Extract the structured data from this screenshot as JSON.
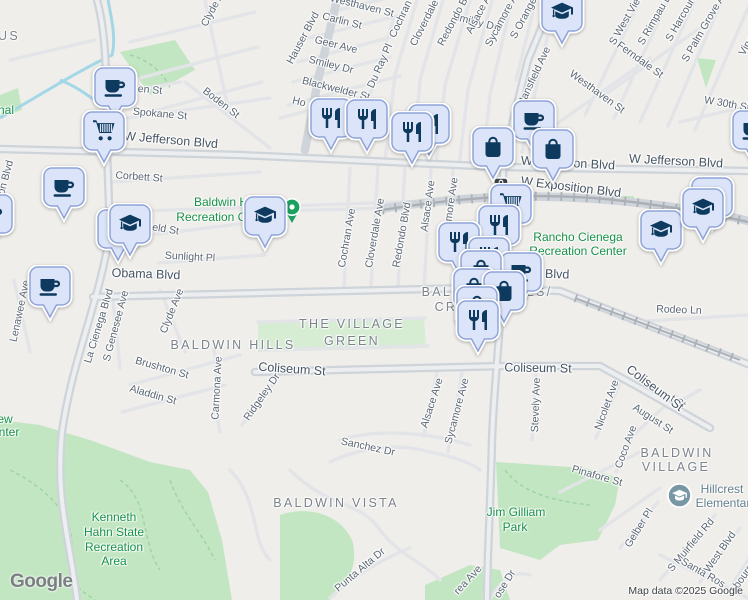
{
  "attribution": {
    "logo": "Google",
    "map_data": "Map data ©2025 Google"
  },
  "palette": {
    "land": "#f0eeea",
    "park_fill": "#c3e6c2",
    "park_label": "#179149",
    "pin_fill": "#dbe4f8",
    "pin_border": "#8fa3d7",
    "pin_icon": "#0d3a5e",
    "street_label": "#5a6673",
    "district_label": "#7b838b",
    "green_dot": "#1aa05f",
    "school_poi": "#7897a5",
    "water": "#a3d7e8"
  },
  "map": {
    "labels": [
      [
        "Smiley Dr",
        475,
        22,
        14,
        "st"
      ],
      [
        "Clyde Ave",
        215,
        5,
        -62,
        "st"
      ],
      [
        "Westhaven St",
        362,
        6,
        14,
        "st"
      ],
      [
        "Carlin St",
        342,
        21,
        14,
        "st"
      ],
      [
        "Geer Ave",
        336,
        45,
        14,
        "st"
      ],
      [
        "Smiley Dr",
        331,
        65,
        14,
        "st"
      ],
      [
        "Blackwelder St",
        336,
        89,
        14,
        "st"
      ],
      [
        "Ho",
        299,
        102,
        14,
        "st"
      ],
      [
        "Hauser Blvd",
        303,
        38,
        -62,
        "st"
      ],
      [
        "Du Ray Pl",
        380,
        66,
        -66,
        "st"
      ],
      [
        "Cochran Ave",
        405,
        10,
        -65,
        "st"
      ],
      [
        "Cloverdale Ave",
        429,
        14,
        -63,
        "st"
      ],
      [
        "Redondo Blvd",
        456,
        16,
        -62,
        "st"
      ],
      [
        "Alsace Ave",
        481,
        10,
        -62,
        "st"
      ],
      [
        "Sycamore Ave",
        504,
        16,
        -62,
        "st"
      ],
      [
        "S Orange Dr",
        527,
        12,
        -62,
        "st"
      ],
      [
        "Mansfield Ave",
        534,
        77,
        -65,
        "st"
      ],
      [
        "S West View St",
        630,
        13,
        -60,
        "st"
      ],
      [
        "S Rimpau Blvd",
        658,
        14,
        -60,
        "st"
      ],
      [
        "S Harcourt Ave",
        686,
        10,
        -60,
        "st"
      ],
      [
        "S Palm Grove Ave",
        706,
        24,
        -60,
        "st"
      ],
      [
        "Vineyard Ave",
        757,
        28,
        -60,
        "st"
      ],
      [
        "Ferndale St",
        640,
        60,
        36,
        "st"
      ],
      [
        "Westhaven St",
        597,
        92,
        36,
        "st"
      ],
      [
        "W 30th St",
        727,
        104,
        10,
        "st"
      ],
      [
        "Boden St",
        221,
        103,
        38,
        "st"
      ],
      [
        "Spokane St",
        160,
        114,
        5,
        "st"
      ],
      [
        "en St",
        150,
        90,
        5,
        "st"
      ],
      [
        "Corbett St",
        139,
        177,
        4,
        "st"
      ],
      [
        "field St",
        163,
        229,
        9,
        "st"
      ],
      [
        "Sunlight Pl",
        190,
        257,
        3,
        "st"
      ],
      [
        "son Blvd",
        5,
        180,
        -75,
        "st"
      ],
      [
        "Cochran Ave",
        347,
        238,
        -80,
        "st"
      ],
      [
        "Cloverdale Ave",
        375,
        233,
        -80,
        "st"
      ],
      [
        "Redondo Blvd",
        402,
        235,
        -80,
        "st"
      ],
      [
        "Alsace Ave",
        428,
        206,
        -82,
        "st"
      ],
      [
        "Sycamore Ave",
        450,
        211,
        -82,
        "st"
      ],
      [
        "La Cienega Blvd",
        99,
        326,
        -73,
        "st"
      ],
      [
        "S Genesee Ave",
        116,
        326,
        -75,
        "st"
      ],
      [
        "Lenawee Ave",
        20,
        311,
        -78,
        "st"
      ],
      [
        "Clyde Ave",
        172,
        311,
        -68,
        "st"
      ],
      [
        "Brushton St",
        162,
        368,
        16,
        "st"
      ],
      [
        "Aladdin St",
        153,
        395,
        16,
        "st"
      ],
      [
        "Carmona Ave",
        217,
        388,
        -87,
        "st"
      ],
      [
        "Ridgeley Dr",
        262,
        397,
        -55,
        "st"
      ],
      [
        "Rodeo Ln",
        679,
        310,
        2,
        "st"
      ],
      [
        "Alsace Ave",
        432,
        403,
        -72,
        "st"
      ],
      [
        "Sycamore Ave",
        457,
        411,
        -75,
        "st"
      ],
      [
        "Stevely Ave",
        536,
        405,
        -88,
        "st"
      ],
      [
        "Nicolet Ave",
        607,
        405,
        -70,
        "st"
      ],
      [
        "August St",
        653,
        419,
        33,
        "st"
      ],
      [
        "t St",
        678,
        402,
        33,
        "st"
      ],
      [
        "Coco Ave",
        626,
        447,
        -70,
        "st"
      ],
      [
        "Pinafore St",
        597,
        476,
        16,
        "st"
      ],
      [
        "Sanchez Dr",
        368,
        447,
        12,
        "st"
      ],
      [
        "Punta Alta Dr",
        360,
        570,
        -40,
        "st"
      ],
      [
        "ose Dr",
        505,
        584,
        -58,
        "st"
      ],
      [
        "rea Ave",
        468,
        580,
        -47,
        "st"
      ],
      [
        "Gelber Pl",
        639,
        528,
        -58,
        "st"
      ],
      [
        "S Muirfield Rd",
        691,
        545,
        -50,
        "st"
      ],
      [
        "West Blvd",
        720,
        552,
        -55,
        "st"
      ],
      [
        "Santa Ros",
        703,
        573,
        30,
        "st"
      ],
      [
        "Abourne Rd",
        748,
        570,
        -55,
        "st"
      ],
      [
        "W Jefferson Blvd",
        171,
        140,
        5,
        "stb"
      ],
      [
        "W Jefferson Blvd",
        568,
        163,
        3,
        "stb"
      ],
      [
        "W Jefferson Blvd",
        676,
        161,
        3,
        "stb"
      ],
      [
        "W Exposition Blvd",
        571,
        187,
        7,
        "stb"
      ],
      [
        "Obama Blvd",
        146,
        274,
        2,
        "stb"
      ],
      [
        "a Blvd",
        552,
        274,
        2,
        "stb"
      ],
      [
        "Coliseum St",
        292,
        369,
        4,
        "stb"
      ],
      [
        "Coliseum St",
        538,
        368,
        1,
        "stb"
      ],
      [
        "Coliseum St",
        655,
        388,
        37,
        "stb"
      ],
      [
        "US",
        9,
        36,
        0,
        "d"
      ],
      [
        "BALDWIN HILLS",
        233,
        345,
        0,
        "d"
      ],
      [
        "THE VILLAGE",
        352,
        324,
        0,
        "d"
      ],
      [
        "GREEN",
        352,
        341,
        0,
        "d"
      ],
      [
        "BALDWIN HILLS/",
        487,
        292,
        0,
        "d"
      ],
      [
        "CRENSHAW",
        480,
        307,
        0,
        "d"
      ],
      [
        "BALDWIN VISTA",
        336,
        503,
        0,
        "d"
      ],
      [
        "BALDWIN",
        677,
        453,
        0,
        "d"
      ],
      [
        "VILLAGE",
        676,
        467,
        0,
        "d"
      ],
      [
        "nal",
        6,
        110,
        0,
        "p"
      ],
      [
        "Baldwin Hills",
        228,
        202,
        0,
        "p"
      ],
      [
        "Recreation Center",
        225,
        217,
        0,
        "p"
      ],
      [
        "Rancho Cienega",
        578,
        237,
        0,
        "p"
      ],
      [
        "Recreation Center",
        578,
        251,
        0,
        "p"
      ],
      [
        "ew",
        5,
        419,
        0,
        "p"
      ],
      [
        "nter",
        9,
        432,
        0,
        "p"
      ],
      [
        "Kenneth",
        114,
        517,
        0,
        "p"
      ],
      [
        "Hahn State",
        114,
        532,
        0,
        "p"
      ],
      [
        "Recreation",
        114,
        547,
        0,
        "p"
      ],
      [
        "Area",
        114,
        561,
        0,
        "p"
      ],
      [
        "Jim Gilliam",
        516,
        512,
        0,
        "p"
      ],
      [
        "Park",
        515,
        527,
        0,
        "p"
      ],
      [
        "Hillcrest",
        722,
        489,
        0,
        "poi"
      ],
      [
        "Elementary",
        726,
        503,
        0,
        "poi"
      ]
    ],
    "pins": [
      [
        "coffee",
        115,
        88
      ],
      [
        "shopping-cart",
        104,
        132
      ],
      [
        "coffee",
        64,
        188
      ],
      [
        "coffee",
        -8,
        215
      ],
      [
        "graduation-cap",
        118,
        230
      ],
      [
        "graduation-cap",
        130,
        225
      ],
      [
        "coffee",
        50,
        287
      ],
      [
        "green-dot",
        292,
        207
      ],
      [
        "graduation-cap",
        265,
        217
      ],
      [
        "restaurant",
        331,
        119
      ],
      [
        "restaurant",
        367,
        120
      ],
      [
        "restaurant",
        429,
        125
      ],
      [
        "restaurant",
        412,
        133
      ],
      [
        "coffee",
        534,
        121
      ],
      [
        "shopping-bag",
        493,
        148
      ],
      [
        "shopping-bag",
        553,
        150
      ],
      [
        "graduation-cap",
        562,
        13
      ],
      [
        "coffee",
        753,
        131
      ],
      [
        "metro-station",
        501,
        185
      ],
      [
        "shopping-cart",
        511,
        205
      ],
      [
        "restaurant",
        499,
        226
      ],
      [
        "restaurant",
        459,
        243
      ],
      [
        "restaurant",
        489,
        258
      ],
      [
        "coffee",
        521,
        273
      ],
      [
        "shopping-bag",
        481,
        271
      ],
      [
        "shopping-bag",
        474,
        289
      ],
      [
        "shopping-bag",
        504,
        292
      ],
      [
        "shopping-bag",
        477,
        307
      ],
      [
        "restaurant",
        478,
        321
      ],
      [
        "graduation-cap",
        661,
        231
      ],
      [
        "graduation-cap",
        712,
        198
      ],
      [
        "graduation-cap",
        703,
        209
      ],
      [
        "school-poi",
        679,
        495
      ]
    ]
  }
}
